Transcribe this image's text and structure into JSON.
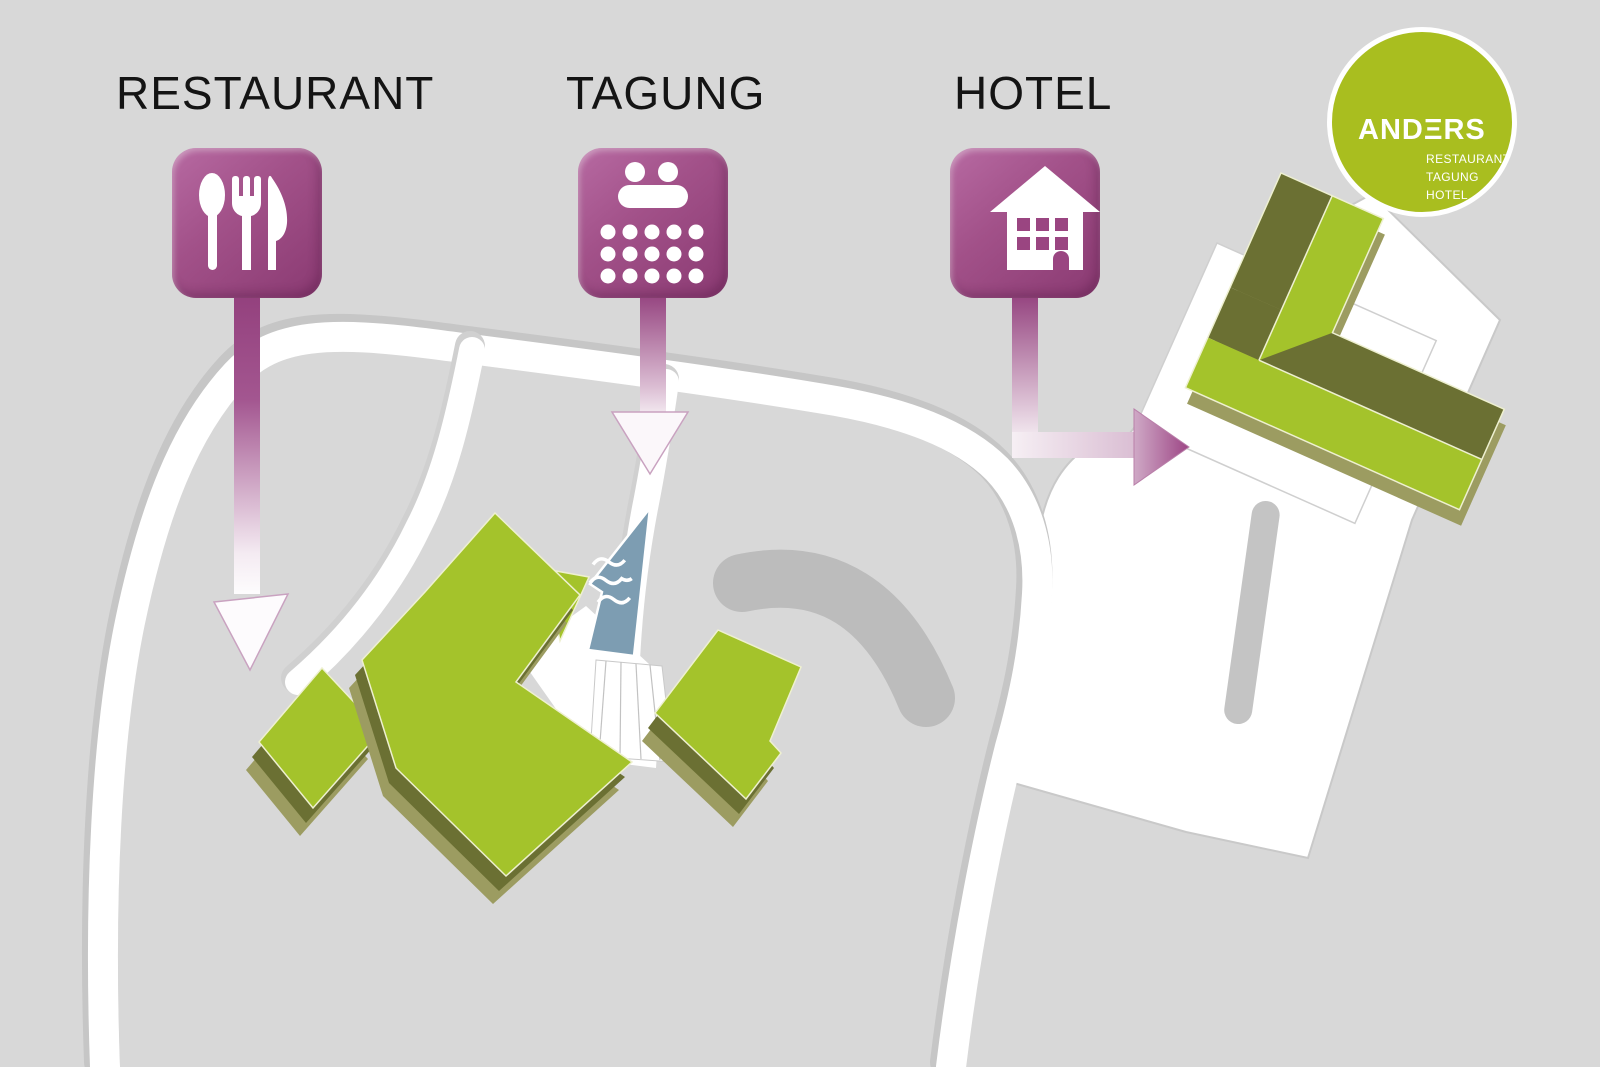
{
  "page": {
    "width": 1600,
    "height": 1067,
    "background": "#d8d8d8"
  },
  "legend": {
    "items": [
      {
        "id": "restaurant",
        "label": "RESTAURANT",
        "icon": "cutlery-icon"
      },
      {
        "id": "tagung",
        "label": "TAGUNG",
        "icon": "conference-seating-icon"
      },
      {
        "id": "hotel",
        "label": "HOTEL",
        "icon": "house-icon"
      }
    ]
  },
  "logo": {
    "brand": "ANDERS",
    "wordmark_display": "ANDΞRS",
    "sublines": [
      "RESTAURANT",
      "TAGUNG",
      "HOTEL"
    ]
  },
  "colors": {
    "background": "#d8d8d8",
    "road": "#ffffff",
    "road_edge": "#c6c6c6",
    "plaza": "#ffffff",
    "plaza_edge": "#c9c9c9",
    "building_top": "#a4c32b",
    "building_side": "#6b7033",
    "building_base": "#9c9c61",
    "building_edge": "#eef0d0",
    "water": "#7d9db2",
    "marker_purple": "#9a4581",
    "logo_green": "#a9be1f",
    "shadow_gray": "#bcbcbc",
    "pill_gray": "#c4c4c4"
  }
}
